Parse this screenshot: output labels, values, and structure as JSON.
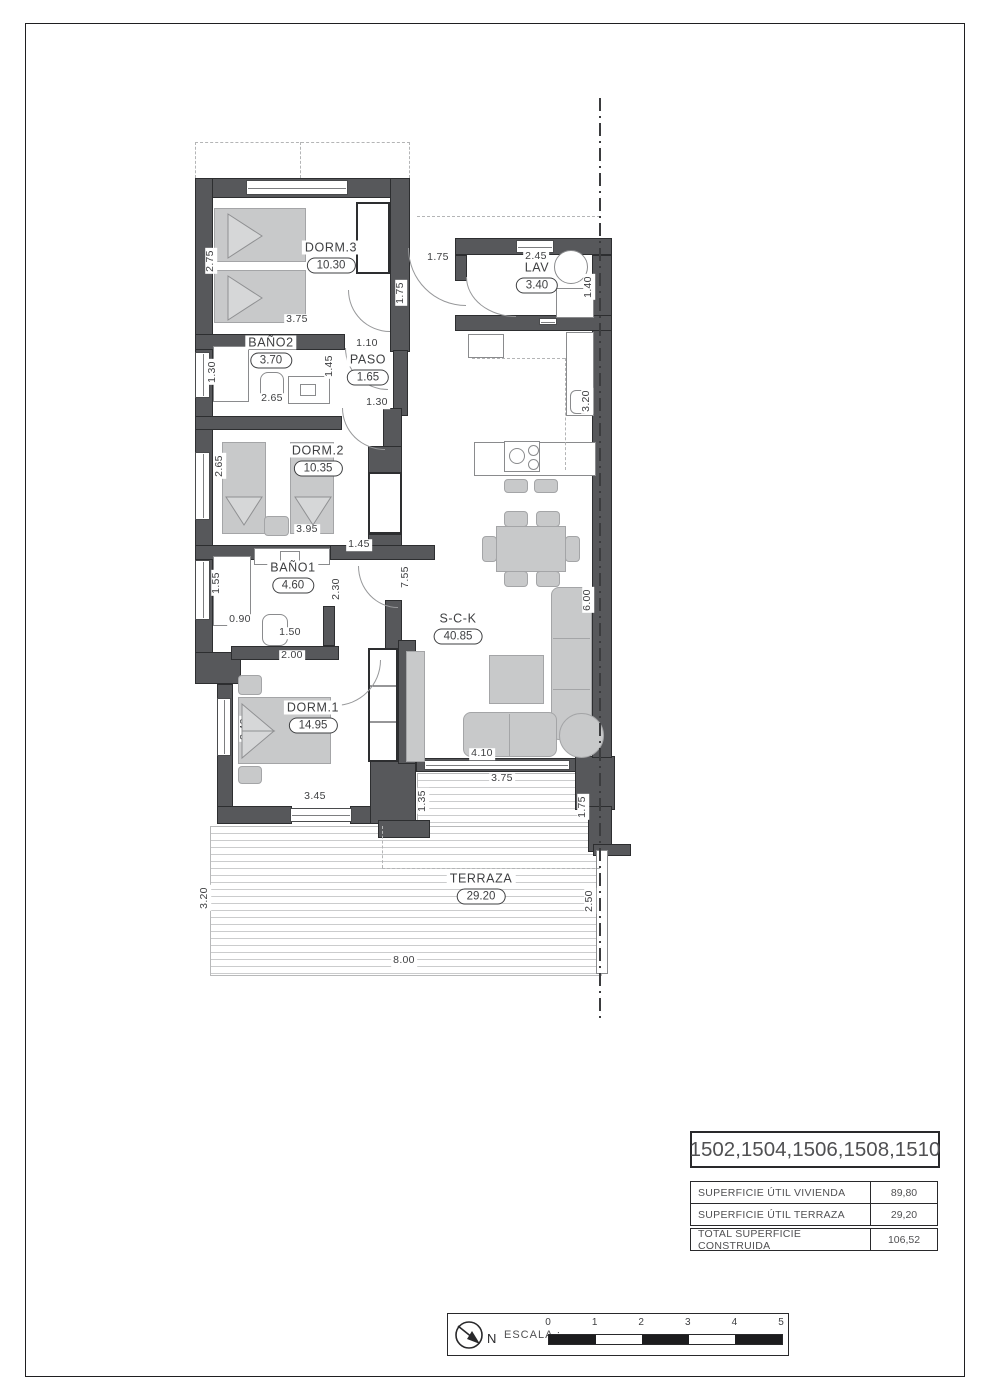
{
  "rooms": [
    {
      "id": "dorm3",
      "name": "DORM.3",
      "area": "10.30",
      "x": 331,
      "y": 257
    },
    {
      "id": "lav",
      "name": "LAV",
      "area": "3.40",
      "x": 537,
      "y": 277
    },
    {
      "id": "bano2",
      "name": "BAÑO2",
      "area": "3.70",
      "x": 271,
      "y": 352
    },
    {
      "id": "paso",
      "name": "PASO",
      "area": "1.65",
      "x": 368,
      "y": 369
    },
    {
      "id": "dorm2",
      "name": "DORM.2",
      "area": "10.35",
      "x": 318,
      "y": 460
    },
    {
      "id": "bano1",
      "name": "BAÑO1",
      "area": "4.60",
      "x": 293,
      "y": 577
    },
    {
      "id": "sck",
      "name": "S-C-K",
      "area": "40.85",
      "x": 458,
      "y": 628
    },
    {
      "id": "dorm1",
      "name": "DORM.1",
      "area": "14.95",
      "x": 313,
      "y": 717
    },
    {
      "id": "terraza",
      "name": "TERRAZA",
      "area": "29.20",
      "x": 481,
      "y": 888
    }
  ],
  "dimensions": [
    {
      "t": "2.75",
      "x": 211,
      "y": 261,
      "r": 1
    },
    {
      "t": "3.75",
      "x": 297,
      "y": 320,
      "r": 0
    },
    {
      "t": "1.75",
      "x": 438,
      "y": 258,
      "r": 0
    },
    {
      "t": "1.75",
      "x": 401,
      "y": 293,
      "r": 1
    },
    {
      "t": "2.45",
      "x": 536,
      "y": 257,
      "r": 0
    },
    {
      "t": "1.40",
      "x": 589,
      "y": 287,
      "r": 1
    },
    {
      "t": "1.30",
      "x": 213,
      "y": 372,
      "r": 1
    },
    {
      "t": "2.65",
      "x": 272,
      "y": 399,
      "r": 0
    },
    {
      "t": "1.45",
      "x": 330,
      "y": 366,
      "r": 1
    },
    {
      "t": "1.10",
      "x": 367,
      "y": 344,
      "r": 0
    },
    {
      "t": "1.30",
      "x": 377,
      "y": 403,
      "r": 0
    },
    {
      "t": "3.20",
      "x": 587,
      "y": 401,
      "r": 1
    },
    {
      "t": "2.65",
      "x": 220,
      "y": 466,
      "r": 1
    },
    {
      "t": "3.95",
      "x": 307,
      "y": 530,
      "r": 0
    },
    {
      "t": "1.45",
      "x": 359,
      "y": 545,
      "r": 0
    },
    {
      "t": "1.55",
      "x": 217,
      "y": 583,
      "r": 1
    },
    {
      "t": "0.90",
      "x": 240,
      "y": 620,
      "r": 0
    },
    {
      "t": "1.50",
      "x": 290,
      "y": 633,
      "r": 0
    },
    {
      "t": "2.30",
      "x": 337,
      "y": 589,
      "r": 1
    },
    {
      "t": "7.55",
      "x": 406,
      "y": 577,
      "r": 1
    },
    {
      "t": "2.00",
      "x": 292,
      "y": 656,
      "r": 0
    },
    {
      "t": "6.00",
      "x": 588,
      "y": 600,
      "r": 1
    },
    {
      "t": "3.40",
      "x": 245,
      "y": 729,
      "r": 1
    },
    {
      "t": "3.45",
      "x": 315,
      "y": 797,
      "r": 0
    },
    {
      "t": "4.10",
      "x": 482,
      "y": 754,
      "r": 0
    },
    {
      "t": "1.35",
      "x": 423,
      "y": 801,
      "r": 1
    },
    {
      "t": "3.75",
      "x": 502,
      "y": 779,
      "r": 0
    },
    {
      "t": "1.75",
      "x": 583,
      "y": 807,
      "r": 1
    },
    {
      "t": "3.20",
      "x": 205,
      "y": 898,
      "r": 1
    },
    {
      "t": "2.50",
      "x": 590,
      "y": 901,
      "r": 1
    },
    {
      "t": "8.00",
      "x": 404,
      "y": 961,
      "r": 0
    }
  ],
  "title_block": {
    "units": "1502,1504,1506,1508,1510",
    "rows": [
      {
        "label": "SUPERFICIE ÚTIL VIVIENDA",
        "value": "89,80"
      },
      {
        "label": "SUPERFICIE ÚTIL TERRAZA",
        "value": "29,20"
      }
    ],
    "total": {
      "label": "TOTAL SUPERFICIE CONSTRUIDA",
      "value": "106,52"
    }
  },
  "scale_bar": {
    "label": "ESCALA :",
    "north_label": "N",
    "ticks": [
      "0",
      "1",
      "2",
      "3",
      "4",
      "5"
    ]
  },
  "colors": {
    "wall": "#57585b",
    "furniture": "#c8c9ca",
    "scale_dark": "#1c1c1e"
  }
}
